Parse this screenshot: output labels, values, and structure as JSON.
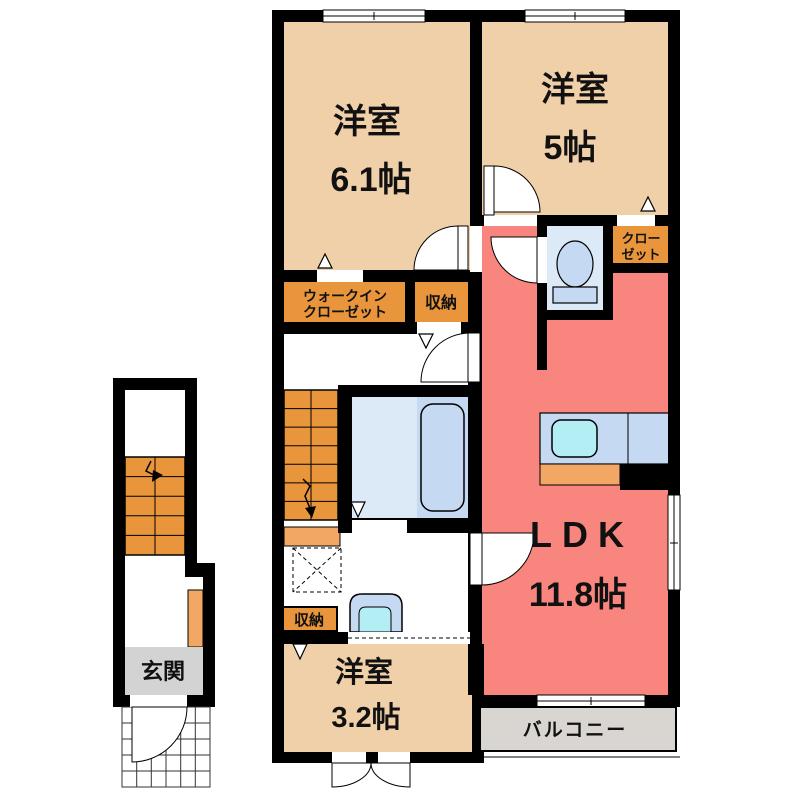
{
  "title": "2F apartment floor plan",
  "colors": {
    "wall": "#000000",
    "room_beige": "#f0d0a9",
    "ldk_pink": "#f8867e",
    "closet_orange": "#e9953c",
    "under_stairs_orange": "#f2a765",
    "bath_floor_blue": "#dceaf8",
    "fixture_blue": "#c5d9f2",
    "water_cyan": "#b2eef4",
    "entrance_gray": "#d3d3d3",
    "balcony_gray": "#d9d5d1"
  },
  "labels": {
    "room_61": {
      "name": "洋室",
      "size": "6.1帖"
    },
    "room_5": {
      "name": "洋室",
      "size": "5帖"
    },
    "ldk": {
      "name": "LDK",
      "size": "11.8帖"
    },
    "room_32": {
      "name": "洋室",
      "size": "3.2帖"
    },
    "wic_line1": "ウォークイン",
    "wic_line2": "クローゼット",
    "storage_top": "収納",
    "storage_bottom": "収納",
    "closet_line1": "クロー",
    "closet_line2": "ゼット",
    "entrance": "玄関",
    "balcony": "バルコニー"
  }
}
